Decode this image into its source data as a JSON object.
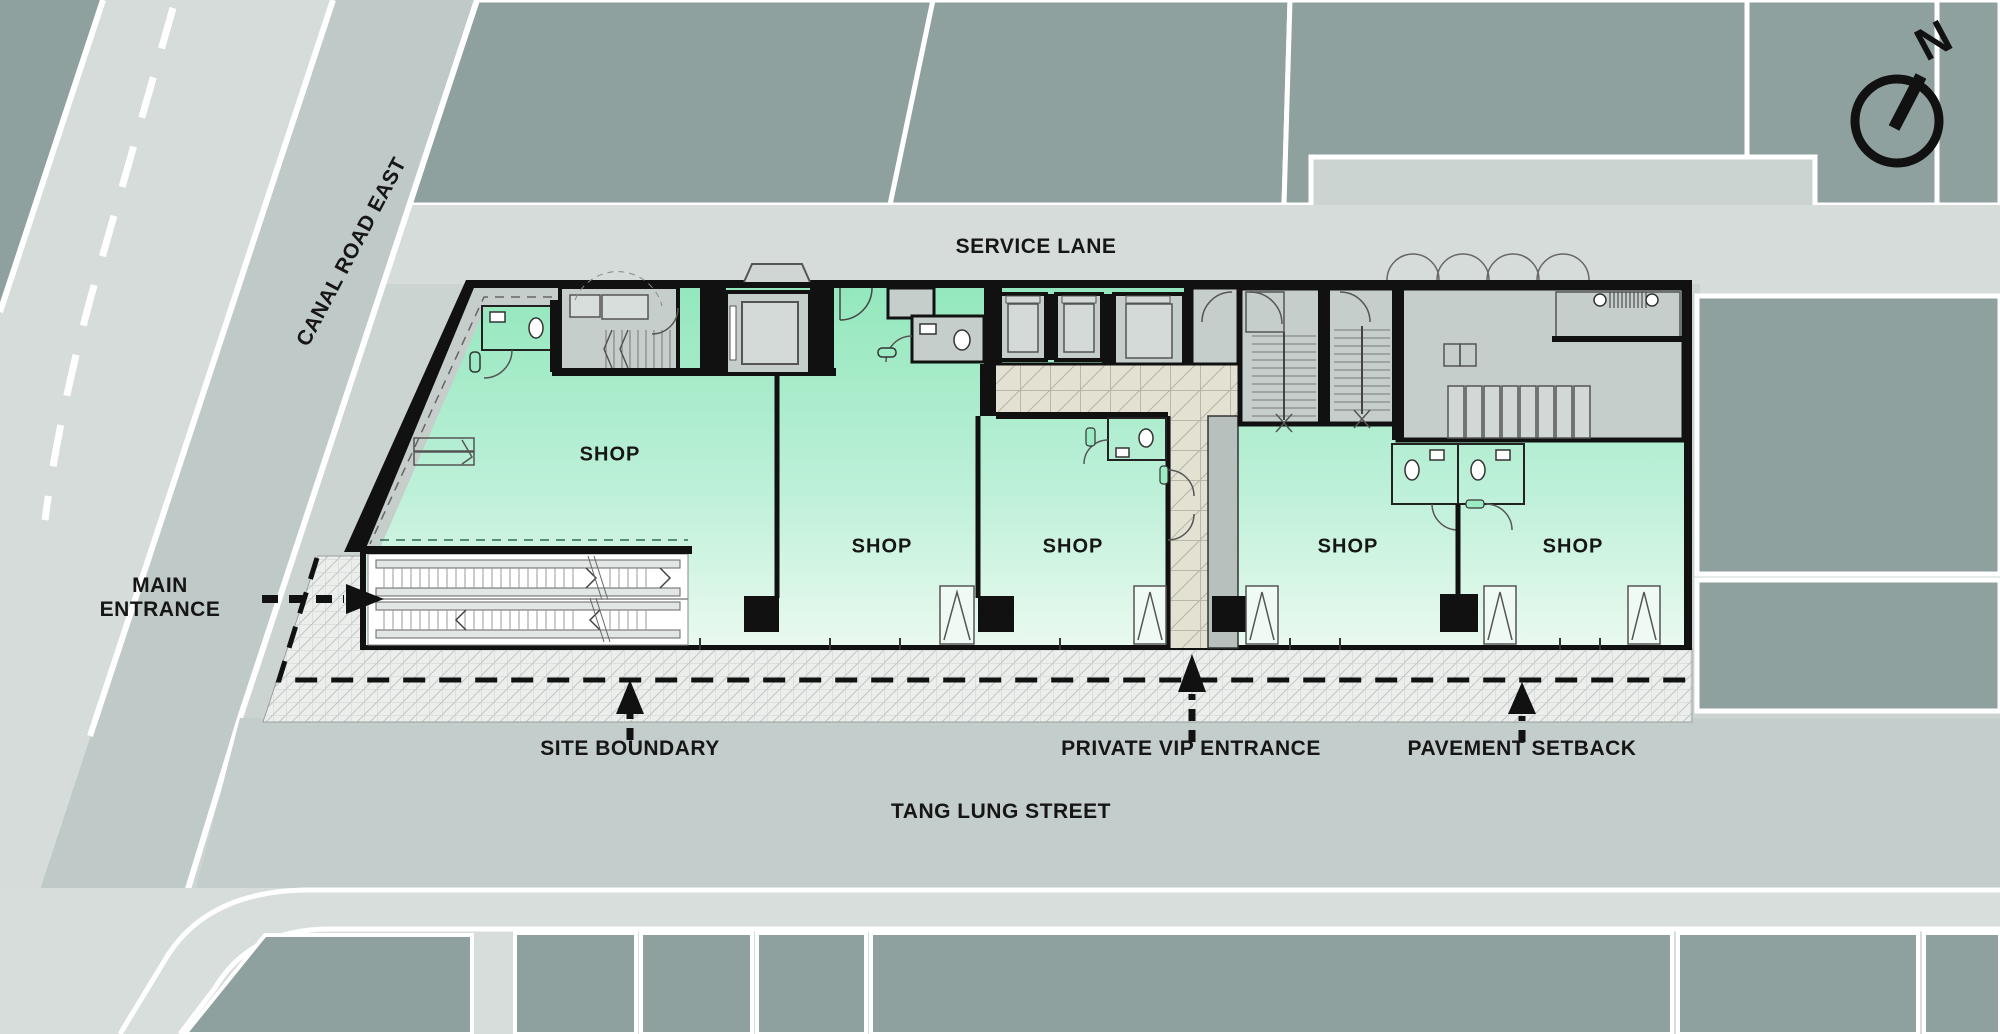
{
  "streets": {
    "service_lane": "SERVICE LANE",
    "canal_road_east": "CANAL ROAD EAST",
    "tang_lung_street": "TANG LUNG STREET"
  },
  "annotations": {
    "main_entrance": "MAIN ENTRANCE",
    "site_boundary": "SITE BOUNDARY",
    "private_vip_entrance": "PRIVATE VIP ENTRANCE",
    "pavement_setback": "PAVEMENT SETBACK"
  },
  "shops": [
    {
      "label": "SHOP"
    },
    {
      "label": "SHOP"
    },
    {
      "label": "SHOP"
    },
    {
      "label": "SHOP"
    },
    {
      "label": "SHOP"
    }
  ],
  "compass": {
    "label": "N"
  },
  "colors": {
    "background": "#ccd4d2",
    "road_light": "#d6dcda",
    "street_band": "#c3cdcb",
    "canal_band": "#bfc9c7",
    "city_block_sage": "#8fa19f",
    "shop_green_top": "#93e7bd",
    "shop_green_bottom": "#ecfaf1",
    "building_gray": "#c6cecb",
    "tile_beige": "#e3e2d2",
    "wall_black": "#111111",
    "pavement_hatch": "#eceeec",
    "line_white": "#ffffff"
  }
}
